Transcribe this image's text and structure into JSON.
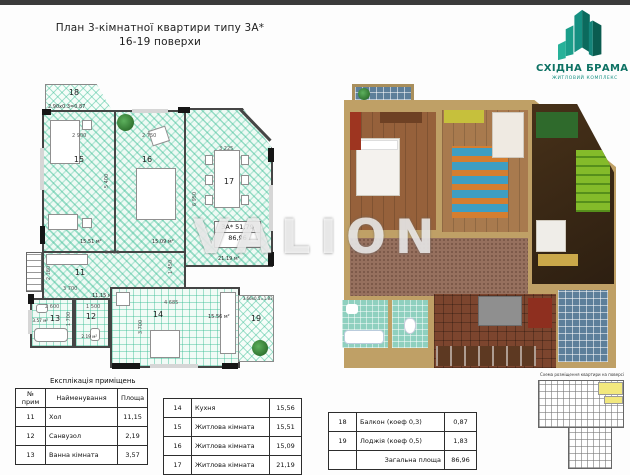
{
  "page": {
    "title_line1": "План 3-кімнатної квартири типу 3А*",
    "title_line2": "16-19 поверхи"
  },
  "logo": {
    "name": "СХІДНА БРАМА",
    "subtitle": "ЖИТЛОВИЙ КОМПЛЕКС",
    "color": "#0e7264"
  },
  "watermark": "VALION",
  "floorplan": {
    "apartment_type": "3А* 51,79",
    "apartment_area": "86,96",
    "room_numbers": {
      "n11": "11",
      "n12": "12",
      "n13": "13",
      "n14": "14",
      "n15": "15",
      "n16": "16",
      "n17": "17",
      "n18": "18",
      "n19": "19"
    },
    "area_labels": {
      "a11": "11.15 м²",
      "a12": "2.19 м²",
      "a13": "3.57 м²",
      "a14": "15.56 м²",
      "a15": "15.51 м²",
      "a16": "15.09 м²",
      "a17": "21.19 м²",
      "balcony": "2.90х0.3=0.87",
      "loggia": "3.66х0.5=1.83"
    },
    "dimensions": {
      "d15": "2 900",
      "d16": "2 750",
      "d17": "3 225",
      "d17v": "6 950",
      "d1516v": "5 400",
      "dhall": "5 750",
      "dhall2": "3 700",
      "dhallv": "2 180",
      "dhallv2": "1 450",
      "d13": "2 600",
      "d12": "1 500",
      "d1312v": "1 700",
      "d14": "4 685",
      "d14v": "3 700"
    }
  },
  "site_plan": {
    "caption": "Схема розміщення квартири на поверсі",
    "highlight_color": "#f2e87e"
  },
  "explication": {
    "title": "Експлікація приміщень",
    "columns": {
      "num": "№ прим",
      "name": "Найменування",
      "area": "Площа"
    },
    "table1": [
      {
        "num": "11",
        "name": "Хол",
        "area": "11,15"
      },
      {
        "num": "12",
        "name": "Санвузол",
        "area": "2,19"
      },
      {
        "num": "13",
        "name": "Ванна кімната",
        "area": "3,57"
      }
    ],
    "table2": [
      {
        "num": "14",
        "name": "Кухня",
        "area": "15,56"
      },
      {
        "num": "15",
        "name": "Житлова кімната",
        "area": "15,51"
      },
      {
        "num": "16",
        "name": "Житлова кімната",
        "area": "15,09"
      },
      {
        "num": "17",
        "name": "Житлова кімната",
        "area": "21,19"
      }
    ],
    "table3": [
      {
        "num": "18",
        "name": "Балкон (коеф 0,3)",
        "area": "0,87"
      },
      {
        "num": "19",
        "name": "Лоджія (коеф 0,5)",
        "area": "1,83"
      },
      {
        "num": "",
        "name": "Загальна площа",
        "area": "86,96"
      }
    ]
  }
}
